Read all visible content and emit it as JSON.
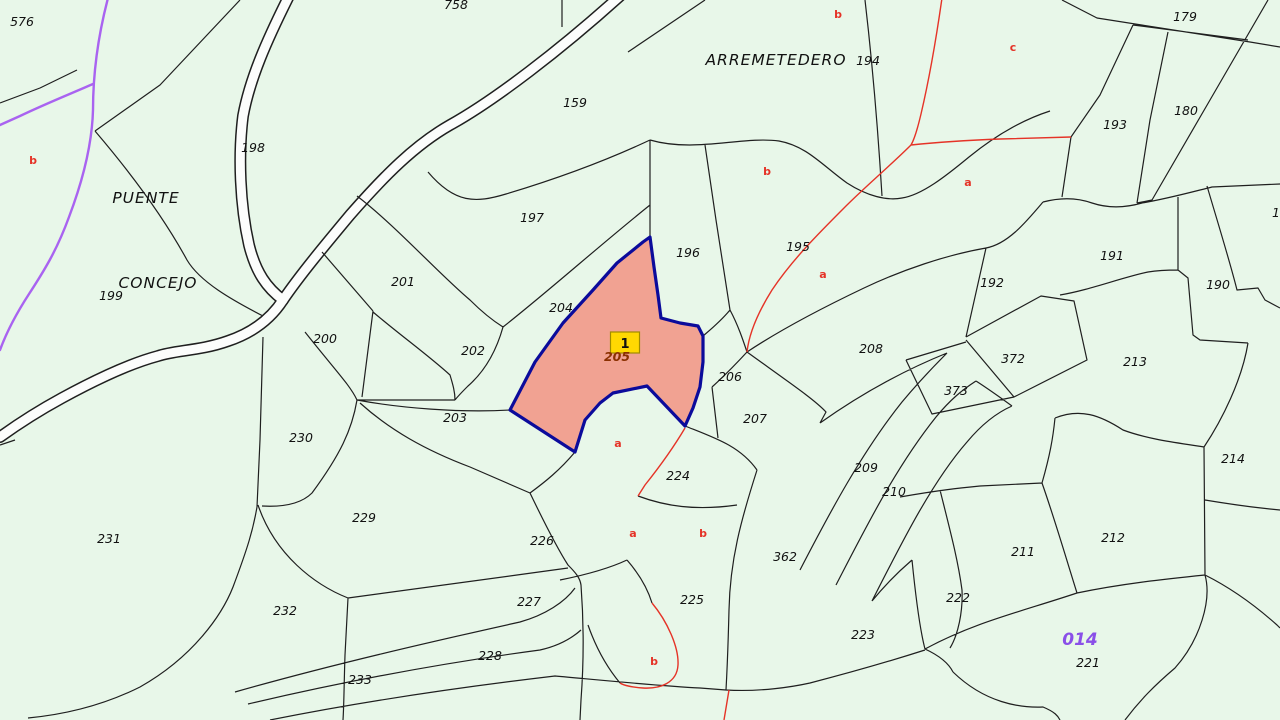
{
  "map": {
    "colors": {
      "background": "#e8f7e9",
      "parcel_line": "#1f1f1f",
      "road_fill": "#fcfdfc",
      "subdivision_red": "#e53327",
      "boundary_purple": "#a963f0",
      "highlight_fill": "#f1a292",
      "highlight_border": "#0b0b9b",
      "badge_fill": "#ffd802",
      "badge_border": "#a08c00",
      "selected_number_color": "#8b3000",
      "zone_color": "#8a4fe8"
    },
    "selected_parcel": {
      "number": "205",
      "badge_label": "1",
      "number_x": 617,
      "number_y": 361,
      "badge_x": 625,
      "badge_y": 347
    },
    "place_names": [
      {
        "text": "PUENTE",
        "x": 146,
        "y": 203
      },
      {
        "text": "CONCEJO",
        "x": 158,
        "y": 288
      },
      {
        "text": "ARREMETEDERO",
        "x": 776,
        "y": 65
      }
    ],
    "zone_label": {
      "text": "014",
      "x": 1080,
      "y": 645
    },
    "parcel_labels": [
      {
        "text": "576",
        "x": 22,
        "y": 26
      },
      {
        "text": "758",
        "x": 456,
        "y": 9
      },
      {
        "text": "179",
        "x": 1185,
        "y": 21
      },
      {
        "text": "180",
        "x": 1186,
        "y": 115
      },
      {
        "text": "193",
        "x": 1115,
        "y": 129
      },
      {
        "text": "194",
        "x": 868,
        "y": 65
      },
      {
        "text": "198",
        "x": 253,
        "y": 152
      },
      {
        "text": "159",
        "x": 575,
        "y": 107
      },
      {
        "text": "197",
        "x": 532,
        "y": 222
      },
      {
        "text": "196",
        "x": 688,
        "y": 257
      },
      {
        "text": "195",
        "x": 798,
        "y": 251
      },
      {
        "text": "199",
        "x": 111,
        "y": 300
      },
      {
        "text": "201",
        "x": 403,
        "y": 286
      },
      {
        "text": "204",
        "x": 561,
        "y": 312
      },
      {
        "text": "200",
        "x": 325,
        "y": 343
      },
      {
        "text": "202",
        "x": 473,
        "y": 355
      },
      {
        "text": "191",
        "x": 1112,
        "y": 260
      },
      {
        "text": "190",
        "x": 1218,
        "y": 289
      },
      {
        "text": "192",
        "x": 992,
        "y": 287
      },
      {
        "text": "208",
        "x": 871,
        "y": 353
      },
      {
        "text": "372",
        "x": 1013,
        "y": 363
      },
      {
        "text": "373",
        "x": 956,
        "y": 395
      },
      {
        "text": "213",
        "x": 1135,
        "y": 366
      },
      {
        "text": "206",
        "x": 730,
        "y": 381
      },
      {
        "text": "207",
        "x": 755,
        "y": 423
      },
      {
        "text": "203",
        "x": 455,
        "y": 422
      },
      {
        "text": "230",
        "x": 301,
        "y": 442
      },
      {
        "text": "224",
        "x": 678,
        "y": 480
      },
      {
        "text": "214",
        "x": 1233,
        "y": 463
      },
      {
        "text": "209",
        "x": 866,
        "y": 472
      },
      {
        "text": "210",
        "x": 894,
        "y": 496
      },
      {
        "text": "229",
        "x": 364,
        "y": 522
      },
      {
        "text": "226",
        "x": 542,
        "y": 545
      },
      {
        "text": "231",
        "x": 109,
        "y": 543
      },
      {
        "text": "362",
        "x": 785,
        "y": 561
      },
      {
        "text": "212",
        "x": 1113,
        "y": 542
      },
      {
        "text": "211",
        "x": 1023,
        "y": 556
      },
      {
        "text": "227",
        "x": 529,
        "y": 606
      },
      {
        "text": "225",
        "x": 692,
        "y": 604
      },
      {
        "text": "222",
        "x": 958,
        "y": 602
      },
      {
        "text": "232",
        "x": 285,
        "y": 615
      },
      {
        "text": "223",
        "x": 863,
        "y": 639
      },
      {
        "text": "228",
        "x": 490,
        "y": 660
      },
      {
        "text": "233",
        "x": 360,
        "y": 684
      },
      {
        "text": "221",
        "x": 1088,
        "y": 667
      },
      {
        "text": "1",
        "x": 1276,
        "y": 217
      }
    ],
    "subdivision_labels": [
      {
        "text": "b",
        "x": 33,
        "y": 164
      },
      {
        "text": "b",
        "x": 838,
        "y": 18
      },
      {
        "text": "c",
        "x": 1013,
        "y": 51
      },
      {
        "text": "b",
        "x": 767,
        "y": 175
      },
      {
        "text": "a",
        "x": 968,
        "y": 186
      },
      {
        "text": "a",
        "x": 823,
        "y": 278
      },
      {
        "text": "a",
        "x": 618,
        "y": 447
      },
      {
        "text": "a",
        "x": 633,
        "y": 537
      },
      {
        "text": "b",
        "x": 703,
        "y": 537
      },
      {
        "text": "b",
        "x": 654,
        "y": 665
      }
    ]
  }
}
